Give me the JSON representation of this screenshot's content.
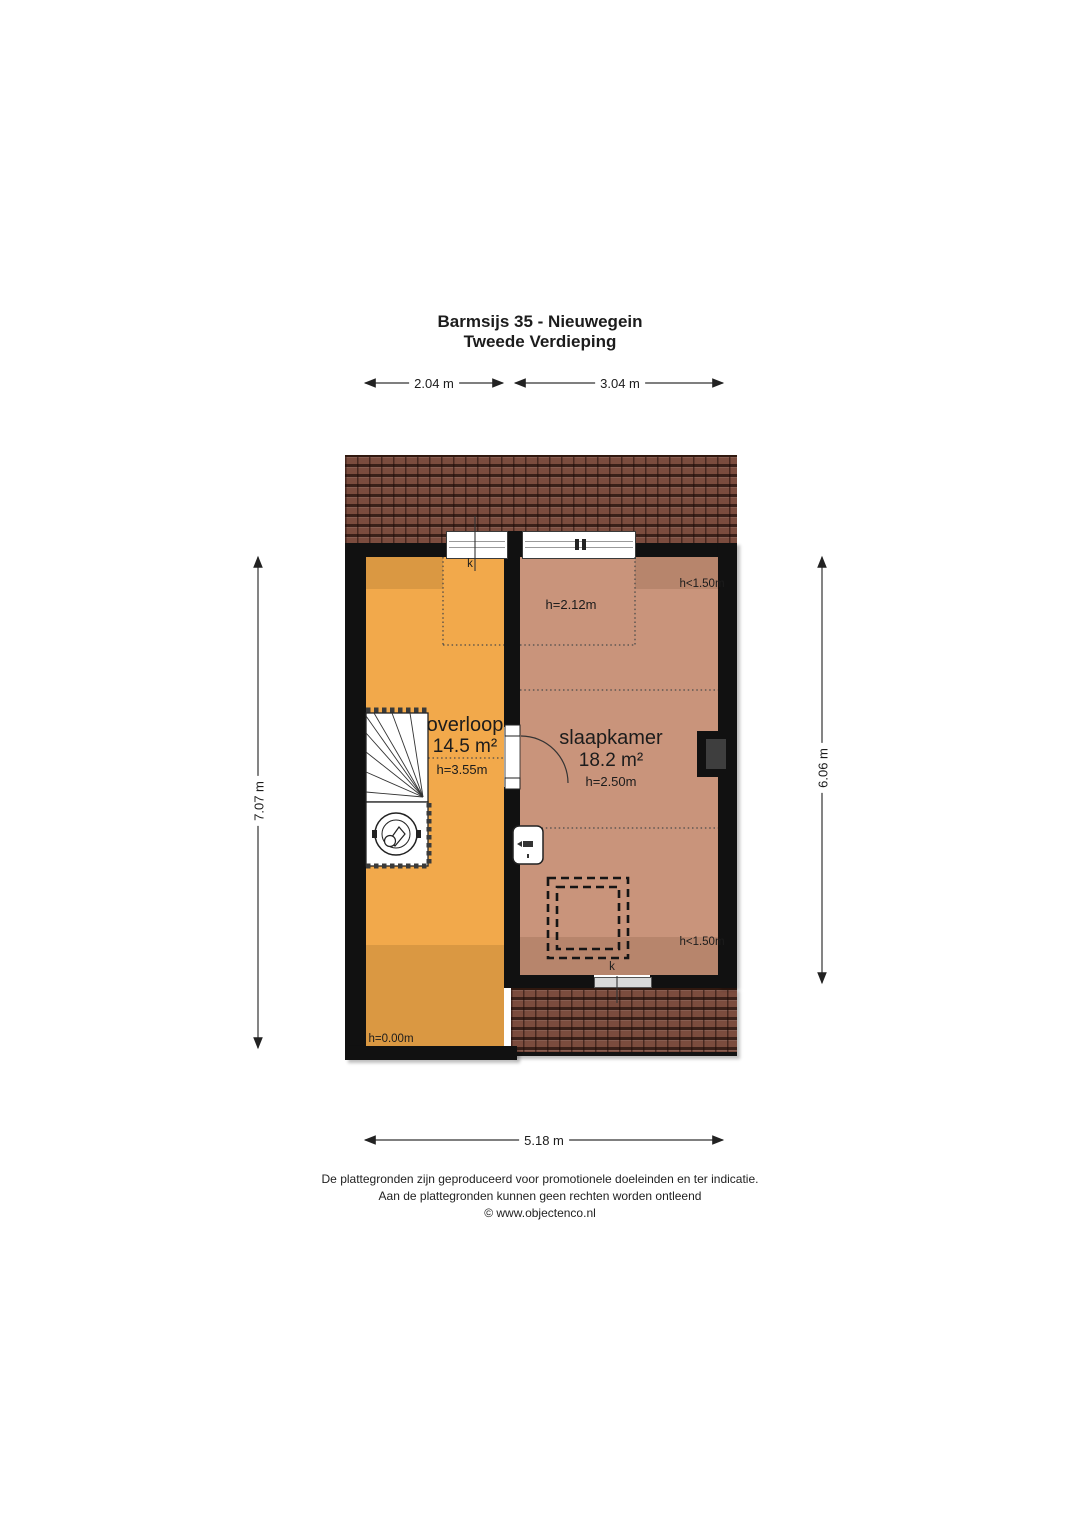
{
  "title": {
    "line1": "Barmsijs 35 - Nieuwegein",
    "line2": "Tweede Verdieping"
  },
  "dimensions": {
    "top_left": "2.04 m",
    "top_right": "3.04 m",
    "left": "7.07 m",
    "right": "6.06 m",
    "bottom": "5.18 m"
  },
  "rooms": {
    "overloop": {
      "name": "overloop",
      "area": "14.5 m²",
      "ceiling_height": "h=3.55m"
    },
    "slaapkamer": {
      "name": "slaapkamer",
      "area": "18.2 m²",
      "ceiling_height": "h=2.50m"
    }
  },
  "labels": {
    "dormer_height": "h=2.12m",
    "low_headroom_top": "h<1.50m",
    "low_headroom_bottom": "h<1.50m",
    "floor_level": "h=0.00m",
    "skylight_top": "k",
    "skylight_bottom": "k"
  },
  "footer": {
    "line1": "De plattegronden zijn geproduceerd voor promotionele doeleinden en ter indicatie.",
    "line2": "Aan de plattegronden kunnen geen rechten worden ontleend",
    "line3": "© www.objectenco.nl"
  },
  "colors": {
    "overloop_fill": "#F2A94B",
    "slaapkamer_fill": "#C9947B",
    "roof": "#7B4C3E",
    "wall": "#111111"
  }
}
